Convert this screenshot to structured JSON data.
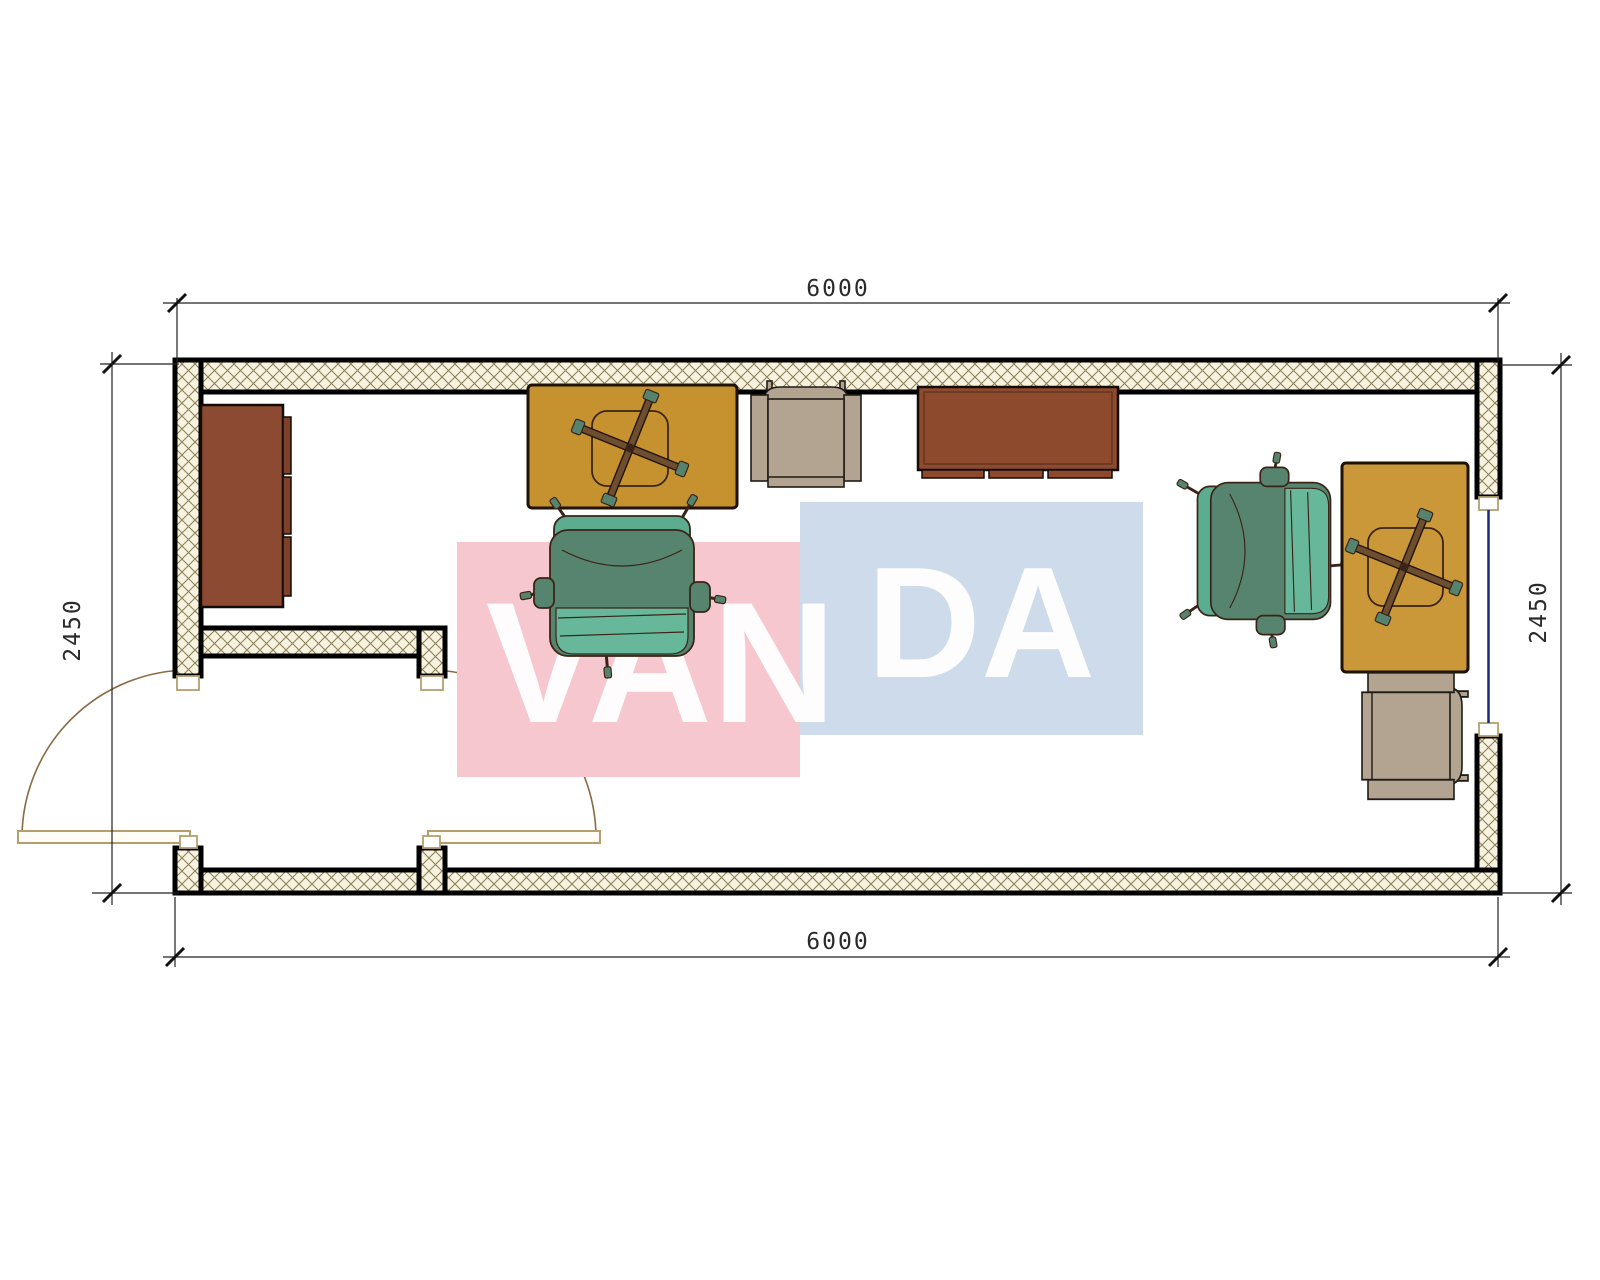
{
  "floor_plan": {
    "type": "architectural-floor-plan",
    "dimensions": {
      "top": "6000",
      "bottom": "6000",
      "left": "2450",
      "right": "2450"
    },
    "watermark": {
      "word_left": "VAN",
      "word_right": "DA",
      "tile_pink_color": "#F6C7CF",
      "tile_blue_color": "#CEDBEA",
      "letter_color": "#FFFFFF"
    },
    "colors": {
      "wall_outline": "#000000",
      "wall_hatch_line": "#8C8258",
      "wall_hatch_bg": "#F8F2E0",
      "door_swing_line": "#8A6A42",
      "door_leaf_outline": "#B49E6E",
      "window_glazing": "#1B2A7A",
      "dimension_line": "#222222",
      "desk_left_top": "#C6922F",
      "desk_right_top": "#CA9839",
      "cabinet_brown": "#8B4A31",
      "sideboard_brown": "#8D4A2D",
      "armchair_beige": "#B3A492",
      "office_chair_seat": "#57846E",
      "office_chair_back": "#5CAD90",
      "office_chair_accent": "#67B79B"
    },
    "symbols": [
      "wall-cabinet",
      "desk-with-task-chair-left",
      "visitor-armchair-top",
      "sideboard-desk",
      "office-chair-center",
      "office-chair-right",
      "desk-with-task-chair-right",
      "visitor-armchair-bottom-right",
      "double-entrance-door",
      "window"
    ]
  }
}
